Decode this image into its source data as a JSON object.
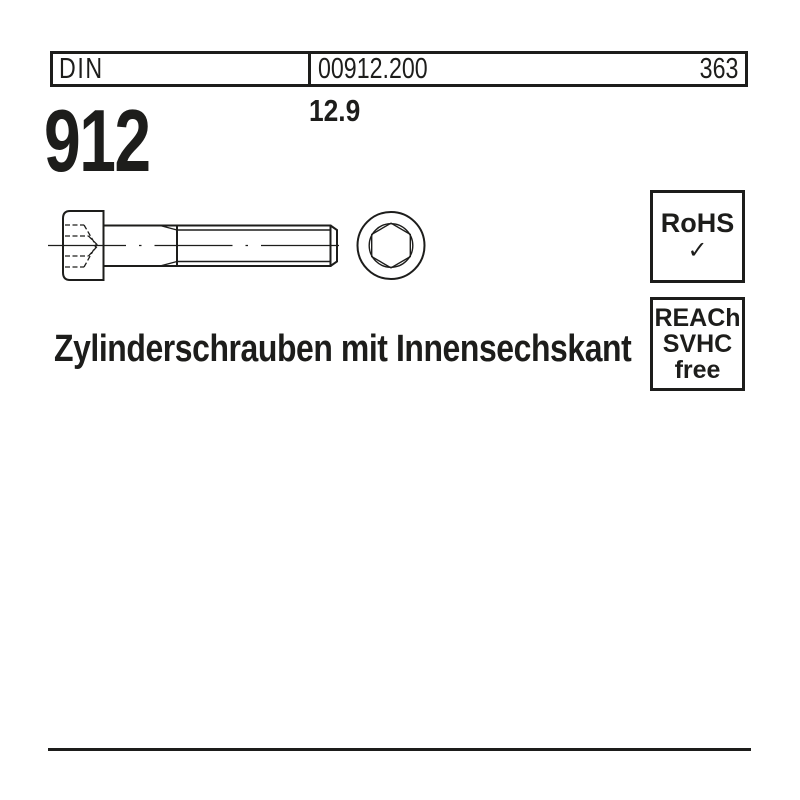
{
  "colors": {
    "ink": "#1d1d1b",
    "background": "#ffffff"
  },
  "header": {
    "standard_label": "DIN",
    "article_number": "00912.200",
    "page_number": "363"
  },
  "product": {
    "standard_number": "912",
    "strength_class": "12.9",
    "title": "Zylinderschrauben mit Innensechskant"
  },
  "compliance": {
    "rohs": {
      "label": "RoHS",
      "check_icon": "✓"
    },
    "reach": {
      "lines": [
        "REACh",
        "SVHC",
        "free"
      ]
    }
  },
  "drawing": {
    "type": "technical-line-drawing",
    "subject": "socket head cap screw, side view with hidden hex socket and threaded shank, front view with hexagon socket"
  }
}
